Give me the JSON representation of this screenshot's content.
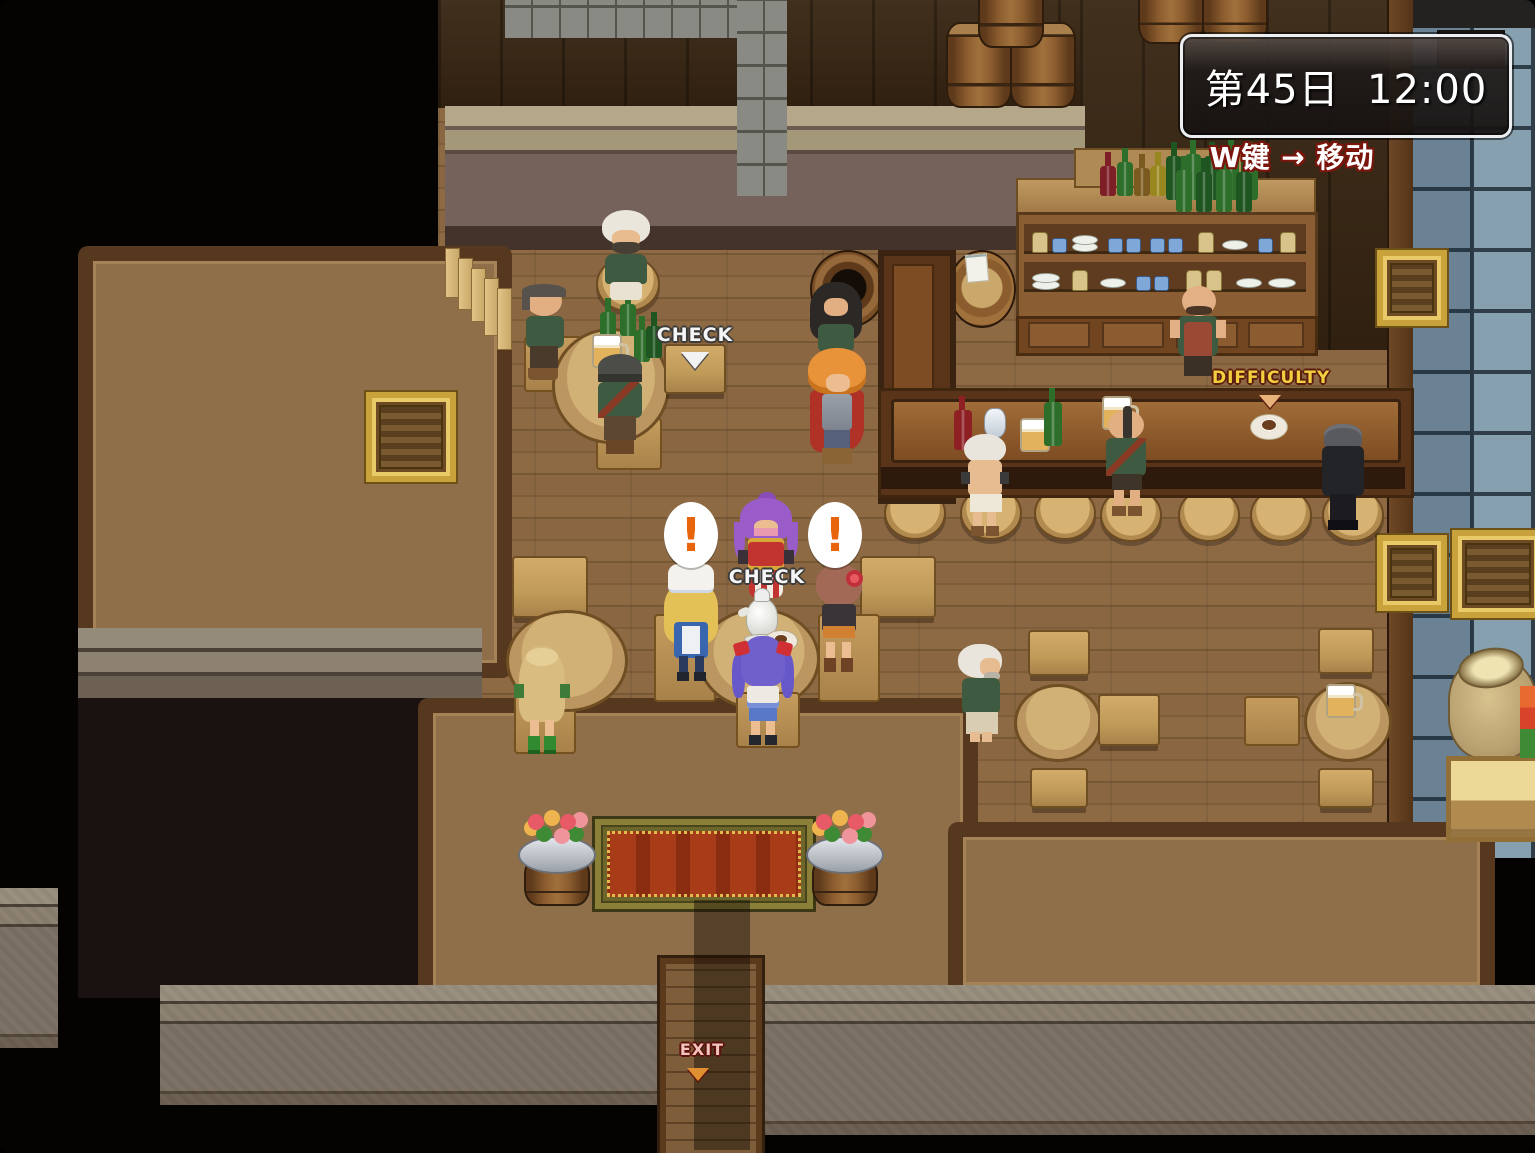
{
  "hud": {
    "day_time": "第45日  12:00",
    "move_hint": "W键 → 移动"
  },
  "prompts": {
    "check_table": "CHECK",
    "check_teapot": "CHECK",
    "difficulty": "DIFFICULTY",
    "exit": "EXIT",
    "alert_left": "!",
    "alert_right": "!"
  },
  "scene": {
    "location": "tavern-interior",
    "characters": [
      "old-man-sitting-top",
      "balding-man",
      "capped-man",
      "longhair-man",
      "hero-orange-hair",
      "bartender",
      "bar-patron-shirtless",
      "bar-patron-mohawk",
      "bar-patron-suit",
      "waitress-blonde-cap",
      "dancer-purple-hair",
      "girl-rose-hair",
      "girl-blue-twintails",
      "girl-long-blonde",
      "old-man-standing"
    ]
  },
  "colors": {
    "hud_border": "#f0f0f0",
    "hint_outline": "#7a150c",
    "check_text": "#f5f5f5",
    "difficulty_text": "#f2cf3e",
    "exit_text": "#f3c3bd",
    "alert_color": "#e8650d"
  }
}
